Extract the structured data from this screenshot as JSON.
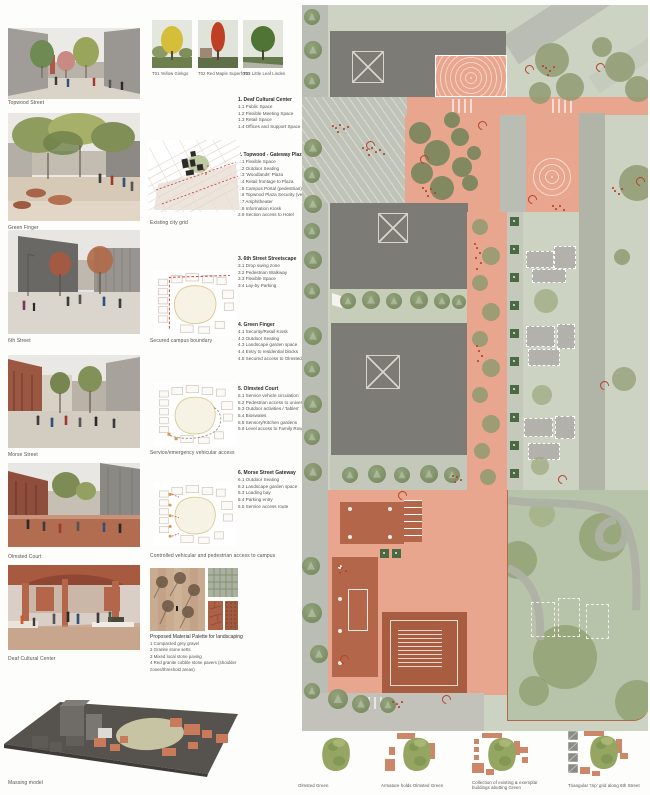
{
  "board": {
    "renders": [
      {
        "caption": "Topwood Street"
      },
      {
        "caption": "Green Finger"
      },
      {
        "caption": "6th Street"
      },
      {
        "caption": "Morse Street"
      },
      {
        "caption": "Olmsted Court"
      },
      {
        "caption": "Deaf Cultural Center"
      }
    ],
    "massing_caption": "Massing model",
    "trees": [
      {
        "label": "T01 Yellow Ginkgo"
      },
      {
        "label": "T02 Red Maple Superform"
      },
      {
        "label": "T03 Little Leaf Linden"
      }
    ],
    "program_blocks": [
      {
        "title": "1. Deaf Cultural Center",
        "items": [
          "1.1 Public Space",
          "1.2 Flexible Meeting Space",
          "1.3 Retail Space",
          "1.4 Offices and Support Space"
        ]
      },
      {
        "title": "2. Topwood - Gateway Plaza",
        "items": [
          "2.1 Flexible Space",
          "2.2 Outdoor Seating",
          "2.3 'Woodlands' Plaza",
          "2.4 Retail frontage to Plaza",
          "2.5 Campus Portal (pedestrian)",
          "2.6 Topwood Plaza Security (vehicle)",
          "2.7 Amphitheater",
          "2.8 Information Kiosk",
          "2.9 Section access to Hotel"
        ]
      },
      {
        "title": "3. 6th Street Streetscape",
        "items": [
          "3.1 Drop swing zone",
          "3.2 Pedestrian Walkway",
          "3.3 Flexible Space",
          "3.4 Lay-by Parking"
        ]
      },
      {
        "title": "4. Green Finger",
        "items": [
          "4.1 Security/Retail Kiosk",
          "4.2 Outdoor Seating",
          "4.3 Landscape garden space",
          "4.4 Entry to residential blocks",
          "4.5 Secured access to Olmsted Court"
        ]
      },
      {
        "title": "5. Olmsted Court",
        "items": [
          "5.1 Service vehicle circulation",
          "5.2 Pedestrian access to university uses",
          "5.3 Outdoor activities / 'tables'",
          "5.4 Bioswales",
          "5.5 Sensory/Kitchen gardens",
          "5.6 Level access to Family Row Homes"
        ]
      },
      {
        "title": "6. Morse Street Gateway",
        "items": [
          "6.1 Outdoor Seating",
          "6.2 Landscape garden space",
          "6.3 Loading bay",
          "6.4 Parking entry",
          "6.5 Service access route"
        ]
      }
    ],
    "diagram_captions": [
      "Existing city grid",
      "Secured campus boundary",
      "Service/emergency vehicular access",
      "Controlled vehicular and pedestrian access to campus"
    ],
    "materials": {
      "title": "Proposed Material Palette for landscaping",
      "items": [
        "1 Compacted grey gravel",
        "2 Granite stone setts",
        "3 Mixed local stone paving",
        "4 Red granite cobble stone pavers (shoulder zones/threshold areas)"
      ]
    },
    "concept_diagrams": [
      {
        "caption": "Olmsted Green"
      },
      {
        "caption": "Armature holds Olmsted Green"
      },
      {
        "caption": "Collection of existing & exemplar buildings abutting Green"
      },
      {
        "caption": "Triangular 'trip' grid along 6th Street"
      }
    ],
    "colors": {
      "plaza_salmon": "#e9a68f",
      "building_grey": "#7b7975",
      "terracotta": "#b4664a",
      "campus_green": "#ccd3c2",
      "park_green": "#b7c3a9",
      "tree_olive": "#8d9a6f",
      "marker_red": "#b5452c"
    }
  }
}
